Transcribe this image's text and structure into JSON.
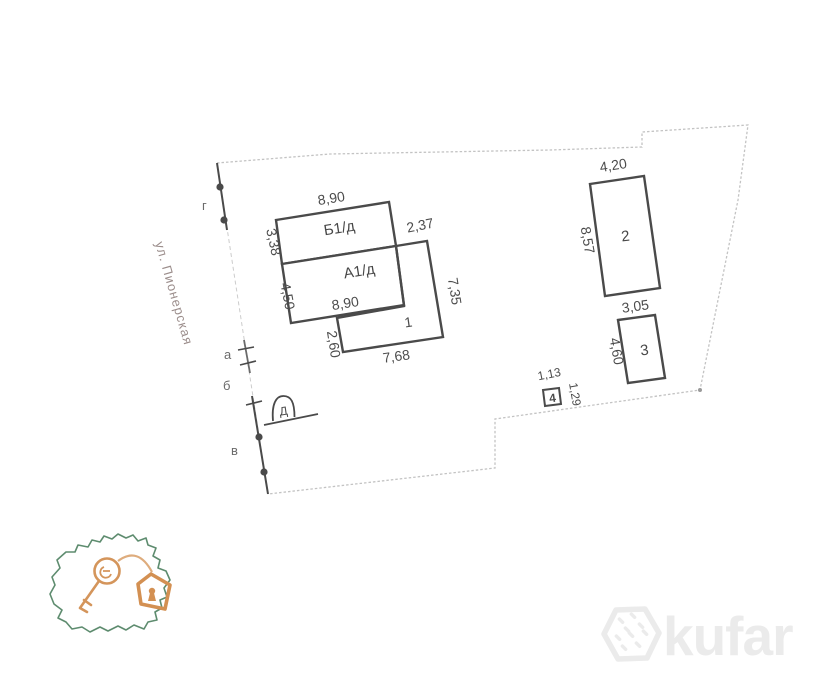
{
  "colors": {
    "building_line": "#4a4a4a",
    "plot_boundary_faint": "#bfbfbf",
    "label_text": "#4c4c4c",
    "street_text": "#9b8d8b",
    "logo_map_green": "#4d8060",
    "logo_key_orange": "#d08a4a",
    "watermark_gray": "#ebebeb"
  },
  "site_plan": {
    "street_label": "ул. Пионерская",
    "boundary_marks": [
      {
        "label": "г"
      },
      {
        "label": "а"
      },
      {
        "label": "б"
      },
      {
        "label": "в"
      }
    ],
    "well_symbol": "Д",
    "buildings": [
      {
        "label": "Б1/д",
        "dim_top": "8,90",
        "dim_left": "3,38"
      },
      {
        "label": "А1/д",
        "dim_left": "4,50",
        "dim_bottom": "8,90"
      },
      {
        "label": "1",
        "dim_top": "2,37",
        "dim_right": "7,35",
        "dim_left": "2,60",
        "dim_bottom": "7,68"
      },
      {
        "label": "2",
        "dim_top": "4,20",
        "dim_left": "8,57"
      },
      {
        "label": "3",
        "dim_top": "3,05",
        "dim_left": "4,60"
      },
      {
        "label": "4",
        "dim_top": "1,13",
        "dim_right": "1,29"
      }
    ]
  },
  "branding": {
    "kufar_wordmark": "kufar"
  }
}
